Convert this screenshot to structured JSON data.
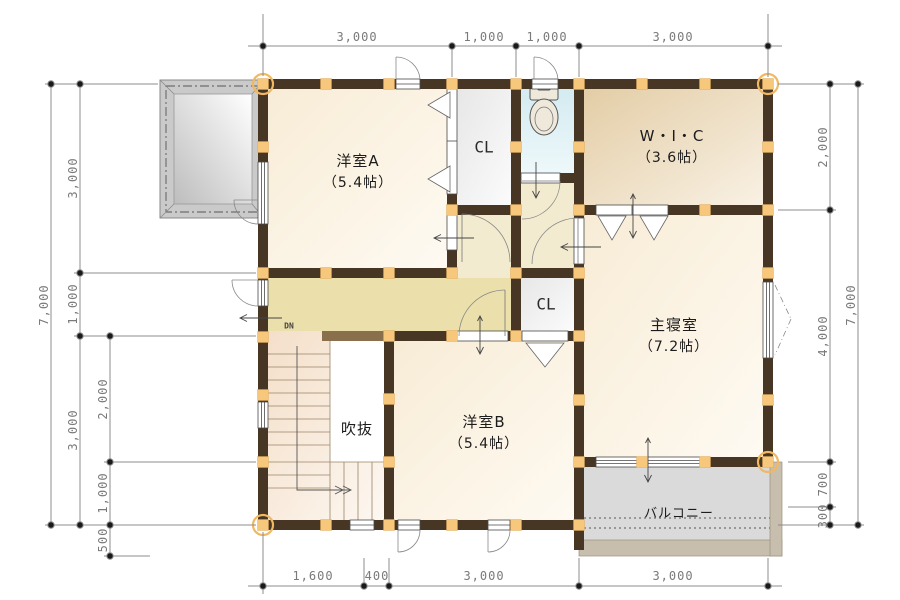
{
  "rooms": {
    "yoshitsu_a": {
      "name": "洋室A",
      "size": "（5.4帖）"
    },
    "cl_top": {
      "name": "CL"
    },
    "wic": {
      "name": "W・I・C",
      "size": "（3.6帖）"
    },
    "master": {
      "name": "主寝室",
      "size": "（7.2帖）"
    },
    "cl_mid": {
      "name": "CL"
    },
    "yoshitsu_b": {
      "name": "洋室B",
      "size": "（5.4帖）"
    },
    "void": {
      "name": "吹抜"
    },
    "balcony": {
      "name": "バルコニー"
    }
  },
  "stairs": {
    "down_label": "DN"
  },
  "dimensions": {
    "top": [
      "3,000",
      "1,000",
      "1,000",
      "3,000"
    ],
    "bottom": [
      "1,600",
      "400",
      "3,000",
      "3,000"
    ],
    "left": {
      "outer": [
        "7,000"
      ],
      "middle": [
        "3,000",
        "1,000",
        "3,000"
      ],
      "inner": [
        "2,000",
        "1,000",
        "500"
      ]
    },
    "right": {
      "inner": [
        "2,000",
        "4,000",
        "700",
        "300"
      ],
      "outer": [
        "7,000"
      ]
    }
  },
  "colors": {
    "wall": "#483624",
    "half_wall": "#8a6f4d",
    "pillar": "#f7c87b",
    "pillar_circle": "#f0b863",
    "corridor": "#ebe0ab",
    "toilet_floor": "#d8ecf1",
    "balcony_floor": "#dadada",
    "dim_line": "#8c8c8c",
    "dim_text": "#7a7a7a"
  }
}
